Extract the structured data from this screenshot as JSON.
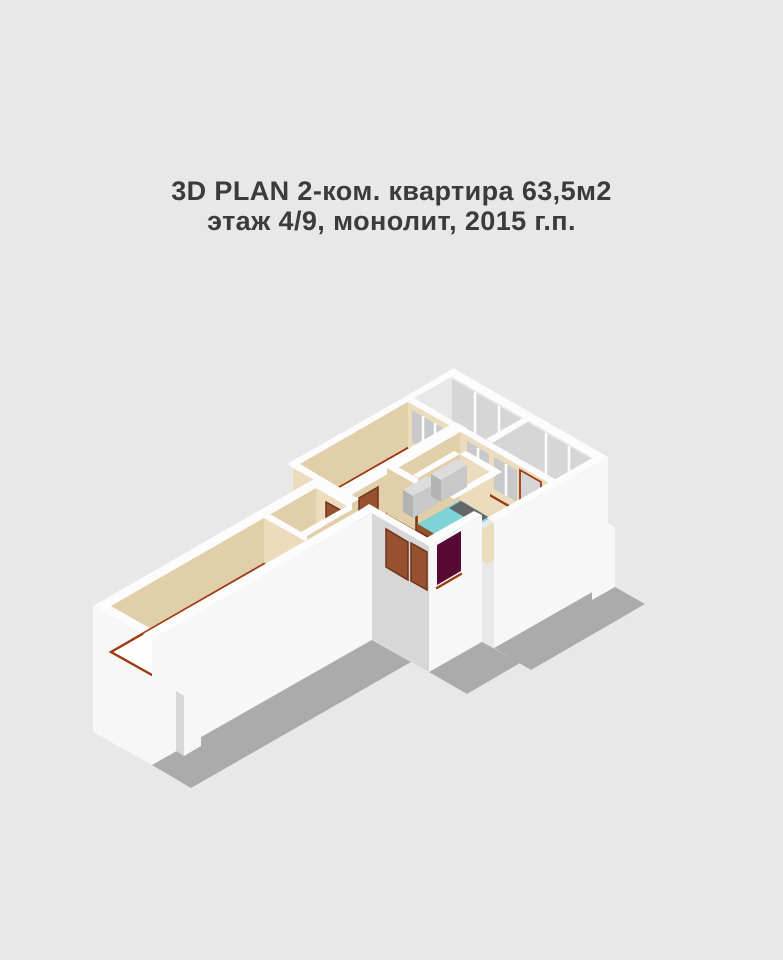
{
  "title": {
    "line1": "3D PLAN 2-ком. квартира 63,5м2",
    "line2": "этаж 4/9, монолит, 2015 г.п."
  },
  "palette": {
    "bg": "#e8e8e8",
    "title": "#3b3b3b",
    "white_top": "#fcfcfc",
    "outer_white": "#f7f7f7",
    "shaded": "#d7d7d7",
    "beige": "#e1cfa9",
    "beige_light": "#ecdcbd",
    "floor_white": "#fefefe",
    "floor_kitchen": "#eaddbf",
    "floor_loggia": "#e0e0e0",
    "cyan": "#7ed3d6",
    "tub_gray": "#636568",
    "teal_accent": "#2ba7b3",
    "door_brown": "#96522f",
    "door_brown_dark": "#703218",
    "door_maroon": "#570a34",
    "window_glass": "#c7c9cb",
    "window_glass_light": "#d6d6d6",
    "trim_red": "#9e3a12",
    "shadow": "#ababab",
    "counter_top": "#dcdcdc",
    "counter_front": "#b3b3b3",
    "counter_side": "#c8c8c8"
  }
}
